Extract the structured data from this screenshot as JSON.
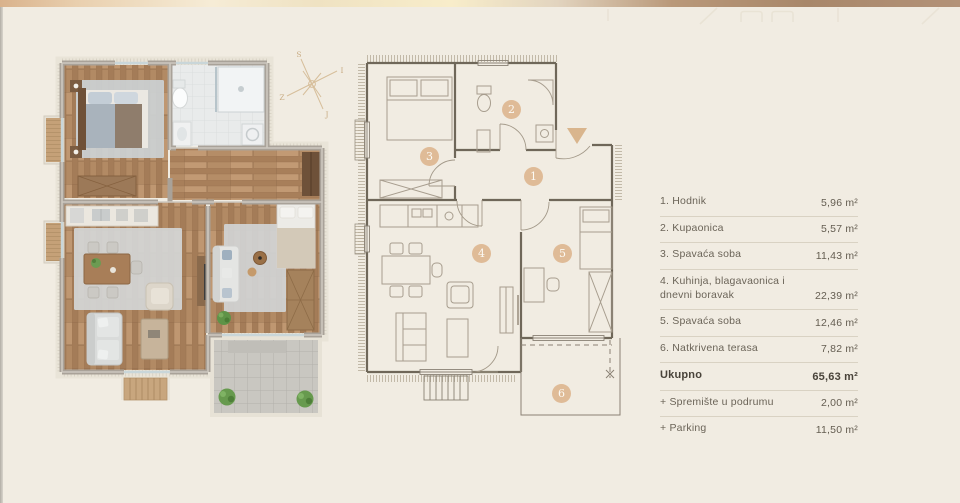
{
  "page": {
    "background": "#f1ece2",
    "topbar_gradient": [
      "#d9b28c",
      "#f6ecd6",
      "#f8edca",
      "#a8876a"
    ],
    "accent_tan": "#dfb993"
  },
  "legend": {
    "rows": [
      {
        "label": "1. Hodnik",
        "value": "5,96 m²"
      },
      {
        "label": "2. Kupaonica",
        "value": "5,57 m²"
      },
      {
        "label": "3. Spavaća soba",
        "value": "11,43 m²"
      },
      {
        "label": "4. Kuhinja, blagavaonica i dnevni boravak",
        "value": "22,39 m²"
      },
      {
        "label": "5. Spavaća soba",
        "value": "12,46 m²"
      },
      {
        "label": "6. Natkrivena terasa",
        "value": "7,82 m²"
      }
    ],
    "total": {
      "label": "Ukupno",
      "value": "65,63 m²"
    },
    "extras": [
      {
        "label": "+ Spremište u podrumu",
        "value": "2,00 m²"
      },
      {
        "label": "+ Parking",
        "value": "11,50 m²"
      }
    ]
  },
  "floorplan": {
    "rooms": [
      {
        "number": "1"
      },
      {
        "number": "2"
      },
      {
        "number": "3"
      },
      {
        "number": "4"
      },
      {
        "number": "5"
      },
      {
        "number": "6"
      }
    ],
    "compass": {
      "n": "S",
      "e": "I",
      "s": "J",
      "w": "Z"
    }
  }
}
